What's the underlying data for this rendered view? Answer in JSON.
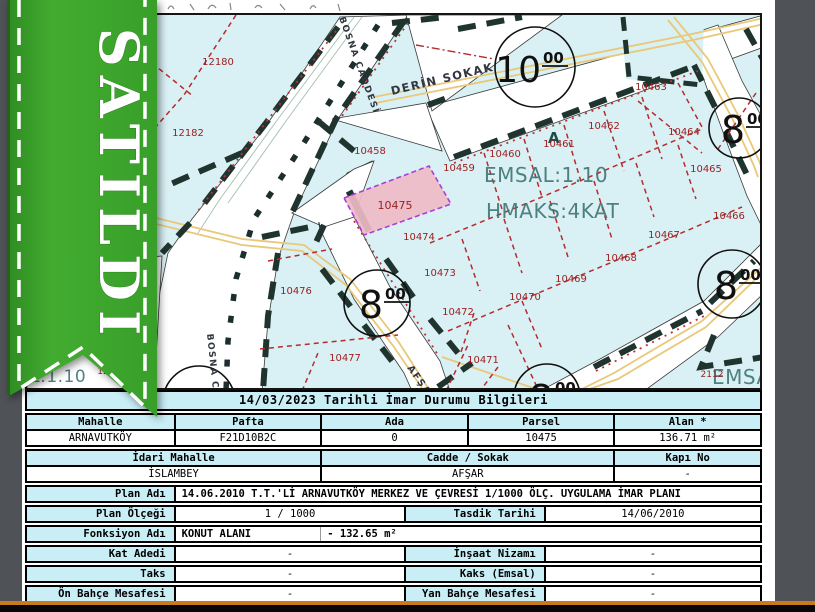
{
  "ribbon": {
    "label": "SATILDI",
    "color": "#3aa32b"
  },
  "map": {
    "background_color": "#d9f0f5",
    "parcel_line_color": "#b62c2c",
    "road_edge_color": "#20342f",
    "road_center_color": "#e9c878",
    "highlight_parcel": {
      "number": "10475",
      "fill": "#eebbc6",
      "border": "#a93fd4"
    },
    "parcel_labels": [
      {
        "n": "12180",
        "x": 216,
        "y": 64
      },
      {
        "n": "12182",
        "x": 186,
        "y": 135
      },
      {
        "n": "12179",
        "x": 137,
        "y": 57
      },
      {
        "n": "10458",
        "x": 368,
        "y": 153
      },
      {
        "n": "10459",
        "x": 457,
        "y": 170
      },
      {
        "n": "10460",
        "x": 503,
        "y": 156
      },
      {
        "n": "10461",
        "x": 557,
        "y": 146
      },
      {
        "n": "10462",
        "x": 602,
        "y": 128
      },
      {
        "n": "10463",
        "x": 649,
        "y": 89
      },
      {
        "n": "10464",
        "x": 682,
        "y": 134
      },
      {
        "n": "10465",
        "x": 704,
        "y": 171
      },
      {
        "n": "10466",
        "x": 727,
        "y": 218
      },
      {
        "n": "10467",
        "x": 662,
        "y": 237
      },
      {
        "n": "10468",
        "x": 619,
        "y": 260
      },
      {
        "n": "10469",
        "x": 569,
        "y": 281
      },
      {
        "n": "10470",
        "x": 523,
        "y": 299
      },
      {
        "n": "10471",
        "x": 481,
        "y": 362
      },
      {
        "n": "10472",
        "x": 456,
        "y": 314
      },
      {
        "n": "10473",
        "x": 438,
        "y": 275
      },
      {
        "n": "10474",
        "x": 417,
        "y": 239
      },
      {
        "n": "10475",
        "x": 393,
        "y": 208,
        "size": 11
      },
      {
        "n": "10476",
        "x": 294,
        "y": 293
      },
      {
        "n": "10477",
        "x": 343,
        "y": 360
      },
      {
        "n": "12",
        "x": 101,
        "y": 373,
        "size": 9
      },
      {
        "n": "2112",
        "x": 710,
        "y": 376,
        "size": 9
      }
    ],
    "zone_texts": [
      {
        "text": "EMSAL:1.10",
        "x": 482,
        "y": 181,
        "size": 20
      },
      {
        "text": "HMAKS:4KAT",
        "x": 484,
        "y": 217,
        "size": 20
      },
      {
        "text": "EMSAL",
        "x": 710,
        "y": 383,
        "size": 20
      },
      {
        "text": "AL:1.10",
        "x": 16,
        "y": 381,
        "size": 17
      },
      {
        "text": "A",
        "x": 546,
        "y": 142,
        "size": 15,
        "bold": true
      }
    ],
    "street_names": [
      {
        "text": "BOSNA CADDESİ",
        "x": 337,
        "y": 17,
        "rotate": 70,
        "size": 9
      },
      {
        "text": "BOSNA CADDESİ",
        "x": 205,
        "y": 333,
        "rotate": 84,
        "size": 9
      },
      {
        "text": "DERİN SOKAK",
        "x": 390,
        "y": 94,
        "rotate": -13.5,
        "size": 11.5
      },
      {
        "text": "AFŞAR",
        "x": 405,
        "y": 367,
        "rotate": 55,
        "size": 9.5
      }
    ],
    "road_width_markers": [
      {
        "m": "10",
        "sup": "00",
        "x": 533,
        "y": 66,
        "r": 40
      },
      {
        "m": "8",
        "sup": "00",
        "x": 737,
        "y": 127,
        "r": 30
      },
      {
        "m": "8",
        "sup": "00",
        "x": 375,
        "y": 302,
        "r": 33
      },
      {
        "m": "8",
        "sup": "00",
        "x": 730,
        "y": 283,
        "r": 34
      },
      {
        "m": "8",
        "sup": "00",
        "x": 545,
        "y": 396,
        "r": 33
      },
      {
        "m": "",
        "sup": "",
        "x": 197,
        "y": 401,
        "r": 36
      }
    ]
  },
  "table": {
    "title": "14/03/2023 Tarihli İmar Durumu Bilgileri",
    "block1": {
      "headers": [
        "Mahalle",
        "Pafta",
        "Ada",
        "Parsel",
        "Alan *"
      ],
      "values": [
        "ARNAVUTKÖY",
        "F21D10B2C",
        "0",
        "10475",
        "136.71 m²"
      ]
    },
    "block2": {
      "headers": [
        "İdari Mahalle",
        "Cadde / Sokak",
        "Kapı No"
      ],
      "values": [
        "İSLAMBEY",
        "AFŞAR",
        "-"
      ]
    },
    "plan_adi": {
      "label": "Plan Adı",
      "value": "14.06.2010 T.T.'Lİ ARNAVUTKÖY MERKEZ VE ÇEVRESİ 1/1000 ÖLÇ. UYGULAMA İMAR PLANI"
    },
    "plan_olcegi": {
      "label": "Plan Ölçeği",
      "value": "1 / 1000",
      "label2": "Tasdik Tarihi",
      "value2": "14/06/2010"
    },
    "fonksiyon": {
      "label": "Fonksiyon Adı",
      "value": "KONUT ALANI",
      "value2": "- 132.65 m²"
    },
    "kat": {
      "label": "Kat Adedi",
      "value": "-",
      "label2": "İnşaat Nizamı",
      "value2": "-"
    },
    "taks": {
      "label": "Taks",
      "value": "-",
      "label2": "Kaks (Emsal)",
      "value2": "-"
    },
    "bahce": {
      "label": "Ön Bahçe Mesafesi",
      "value": "-",
      "label2": "Yan Bahçe Mesafesi",
      "value2": "-"
    }
  }
}
